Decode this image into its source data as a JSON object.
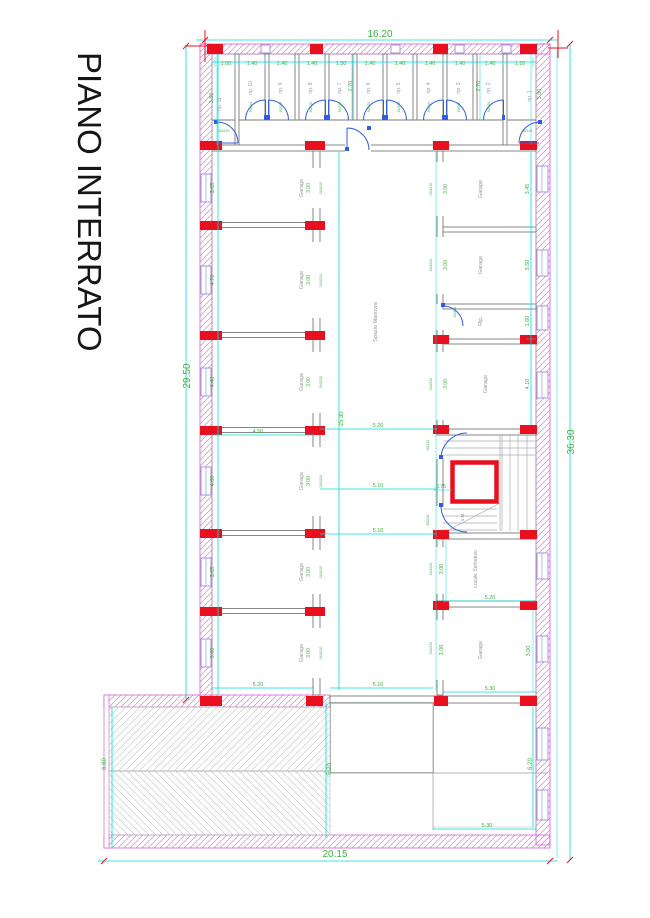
{
  "title": "PIANO INTERRATO",
  "dims": {
    "top_total": "16.20",
    "bottom_total": "20.15",
    "left_total": "29.50",
    "right_total": "36.30",
    "center_height": "25.30",
    "top_widths": [
      "1.00",
      "1.40",
      "1.40",
      "1.40",
      "1.30",
      "1.40",
      "1.40",
      "1.40",
      "1.40",
      "1.40",
      "1.10"
    ],
    "top_depth_left": "3.80",
    "top_depth_mid1": "2.70",
    "top_depth_mid2": "2.70",
    "top_depth_right": "3.80",
    "left_row_heights": [
      "3.65",
      "4.70",
      "4.40",
      "4.60",
      "3.65",
      "3.80"
    ],
    "left_width_mid": "4.50",
    "left_width_bottom": "5.20",
    "center_w1": "5.20",
    "center_w2": "5.10",
    "center_w3": "5.10",
    "center_w_bottom": "5.10",
    "elevator_gap": "0.75",
    "right_row_heights": [
      "3.45",
      "3.50",
      "1.60",
      "4.10"
    ],
    "serbatoio_height": "3.00",
    "serbatoio_width": "5.20",
    "garage_br_height": "3.00",
    "garage_br_height2": "3.00",
    "garage_br_width": "5.30",
    "courtyard_width": "5.30",
    "ramp_left_height": "6.80",
    "ramp_right_height": "6.20",
    "courtyard_height": "6.20",
    "door_dim": "3.00"
  },
  "rooms": {
    "storage_labels": [
      "rip. 11",
      "rip. 10",
      "rip. 9",
      "rip. 8",
      "rip. 7",
      "rip. 6",
      "rip. 5",
      "rip. 4",
      "rip. 3",
      "rip. 2",
      "rip. 1"
    ],
    "garage": "Garage",
    "storage_short": "Rip.",
    "maneuver": "Spazio Manovra",
    "stair": "S.M.",
    "tank_room": "Locale Serbatoio"
  },
  "door_labels": {
    "small": "80/210",
    "garage": "240/210"
  },
  "colors": {
    "dimension_line": "#00dcdc",
    "dimension_text": "#3bb33b",
    "wall_outline": "#d45fd4",
    "column_red": "#e8101e",
    "door_blue": "#2f5fe0",
    "room_text": "#979797",
    "window_purple": "#a08ae0"
  }
}
